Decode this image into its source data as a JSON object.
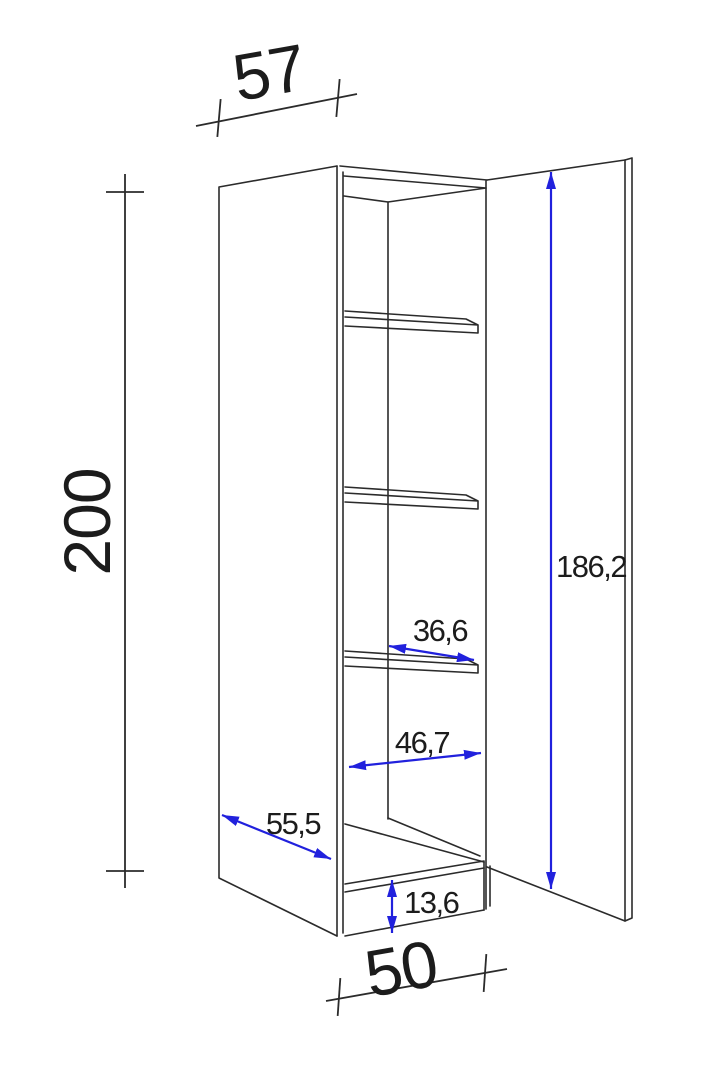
{
  "dimensions": {
    "top_width": "57",
    "total_height": "200",
    "bottom_width": "50",
    "door_height": "186,2",
    "shelf_depth": "36,6",
    "interior_width": "46,7",
    "side_depth": "55,5",
    "plinth_height": "13,6"
  },
  "colors": {
    "line": "#2b2b2b",
    "text": "#1c1c1c",
    "dimension_accent": "#2121dd",
    "background": "#ffffff"
  }
}
